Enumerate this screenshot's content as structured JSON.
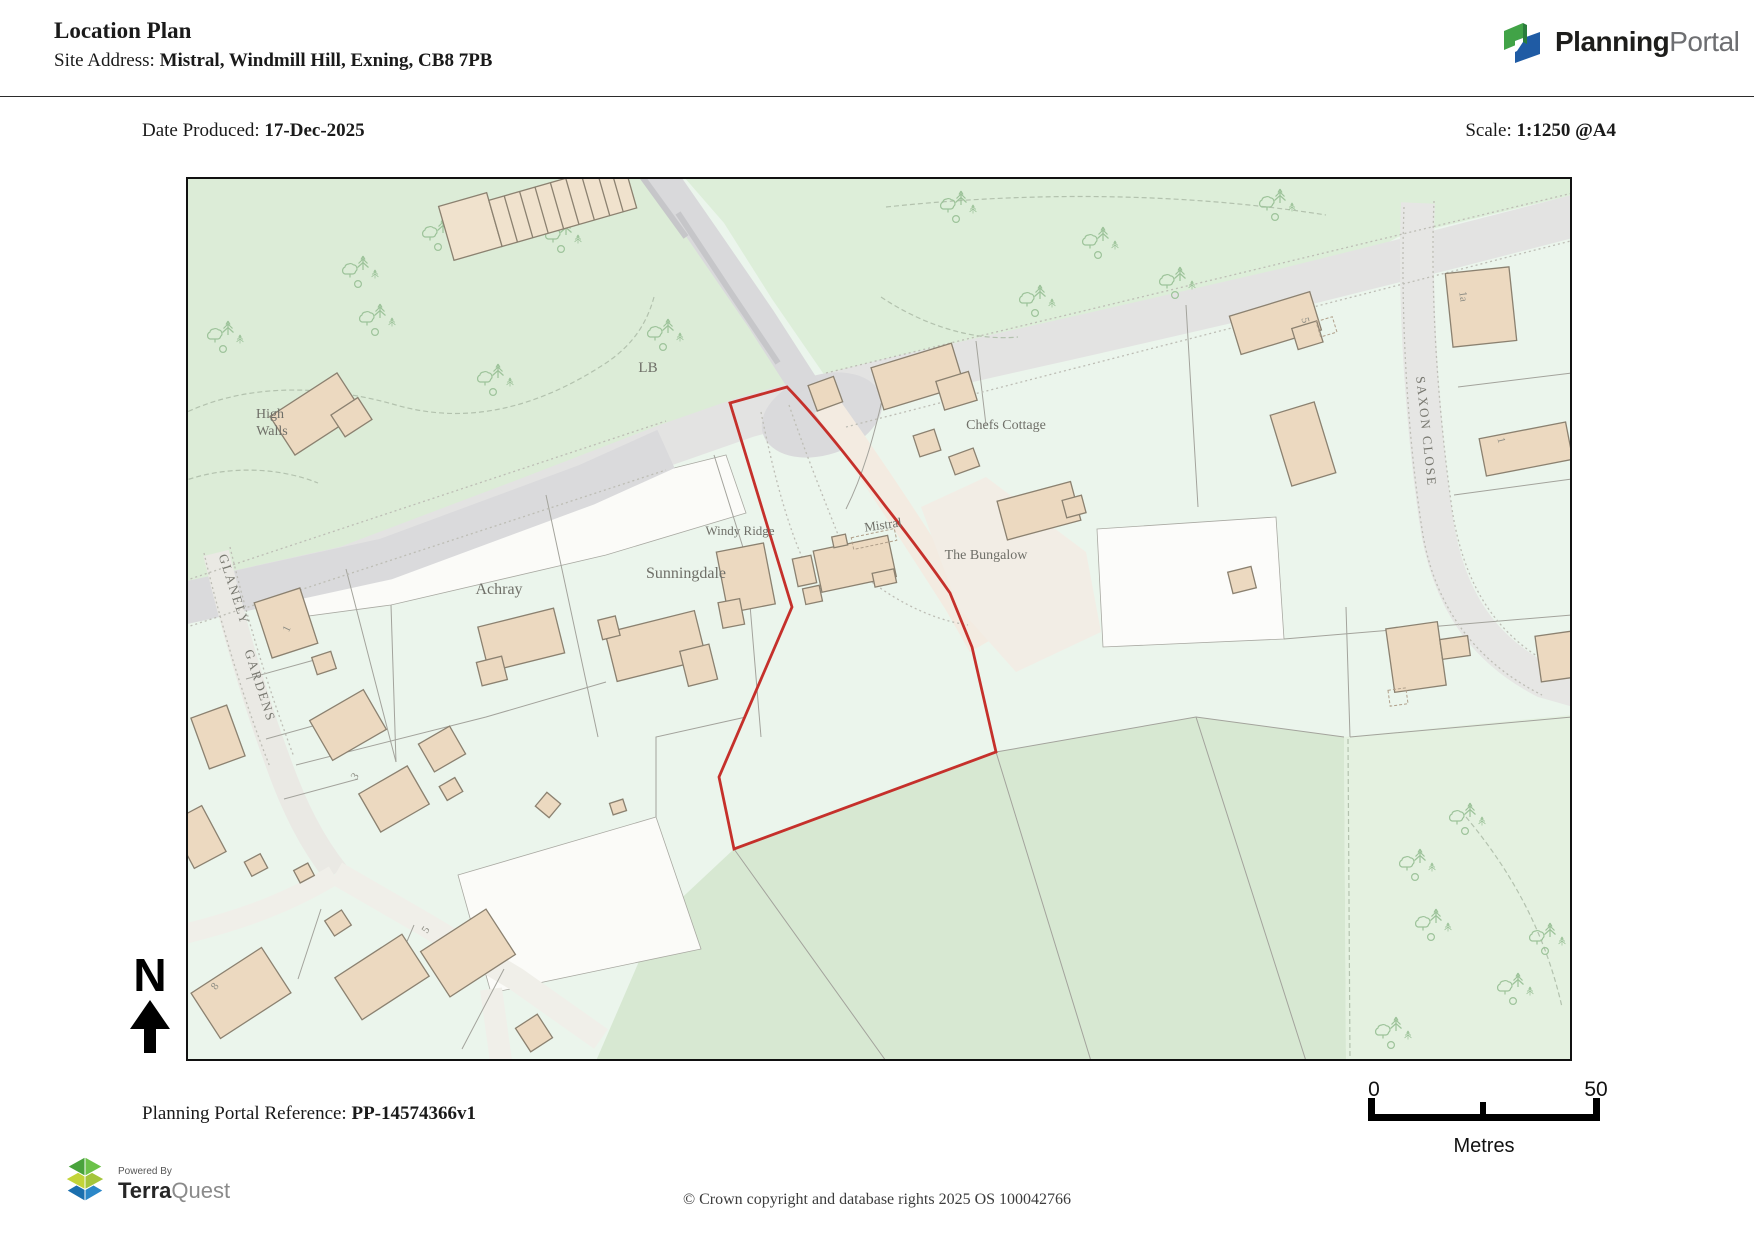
{
  "header": {
    "title": "Location Plan",
    "site_address_label": "Site Address: ",
    "site_address_value": "Mistral, Windmill Hill, Exning, CB8 7PB",
    "brand": {
      "name_bold": "Planning",
      "name_light": "Portal"
    }
  },
  "meta": {
    "date_label": "Date Produced: ",
    "date_value": "17-Dec-2025",
    "scale_label": "Scale: ",
    "scale_value": "1:1250 @A4"
  },
  "map": {
    "site_outline_color": "#c5302b",
    "labels": {
      "lb": "LB",
      "high_walls_line1": "High",
      "high_walls_line2": "Walls",
      "chefs_cottage": "Chefs Cottage",
      "mistral": "Mistral",
      "the_bungalow": "The Bungalow",
      "windy_ridge": "Windy Ridge",
      "sunningdale": "Sunningdale",
      "achray": "Achray",
      "street_glanely": "GLANELY",
      "street_gardens": "GARDENS",
      "street_saxon_close": "SAXON CLOSE",
      "plot_1a": "1a",
      "plot_1_saxon": "1",
      "plot_5_top": "5",
      "plot_1_glanely": "1",
      "plot_3": "3",
      "plot_8": "8",
      "plot_5_bottom": "5"
    }
  },
  "compass": {
    "north_label": "N"
  },
  "scale_bar": {
    "start_label": "0",
    "end_label": "50",
    "unit_label": "Metres"
  },
  "footer": {
    "reference_label": "Planning Portal Reference: ",
    "reference_value": "PP-14574366v1",
    "copyright": "© Crown copyright and database rights 2025 OS 100042766",
    "powered_by": "Powered By",
    "terraquest_bold": "Terra",
    "terraquest_light": "Quest"
  }
}
